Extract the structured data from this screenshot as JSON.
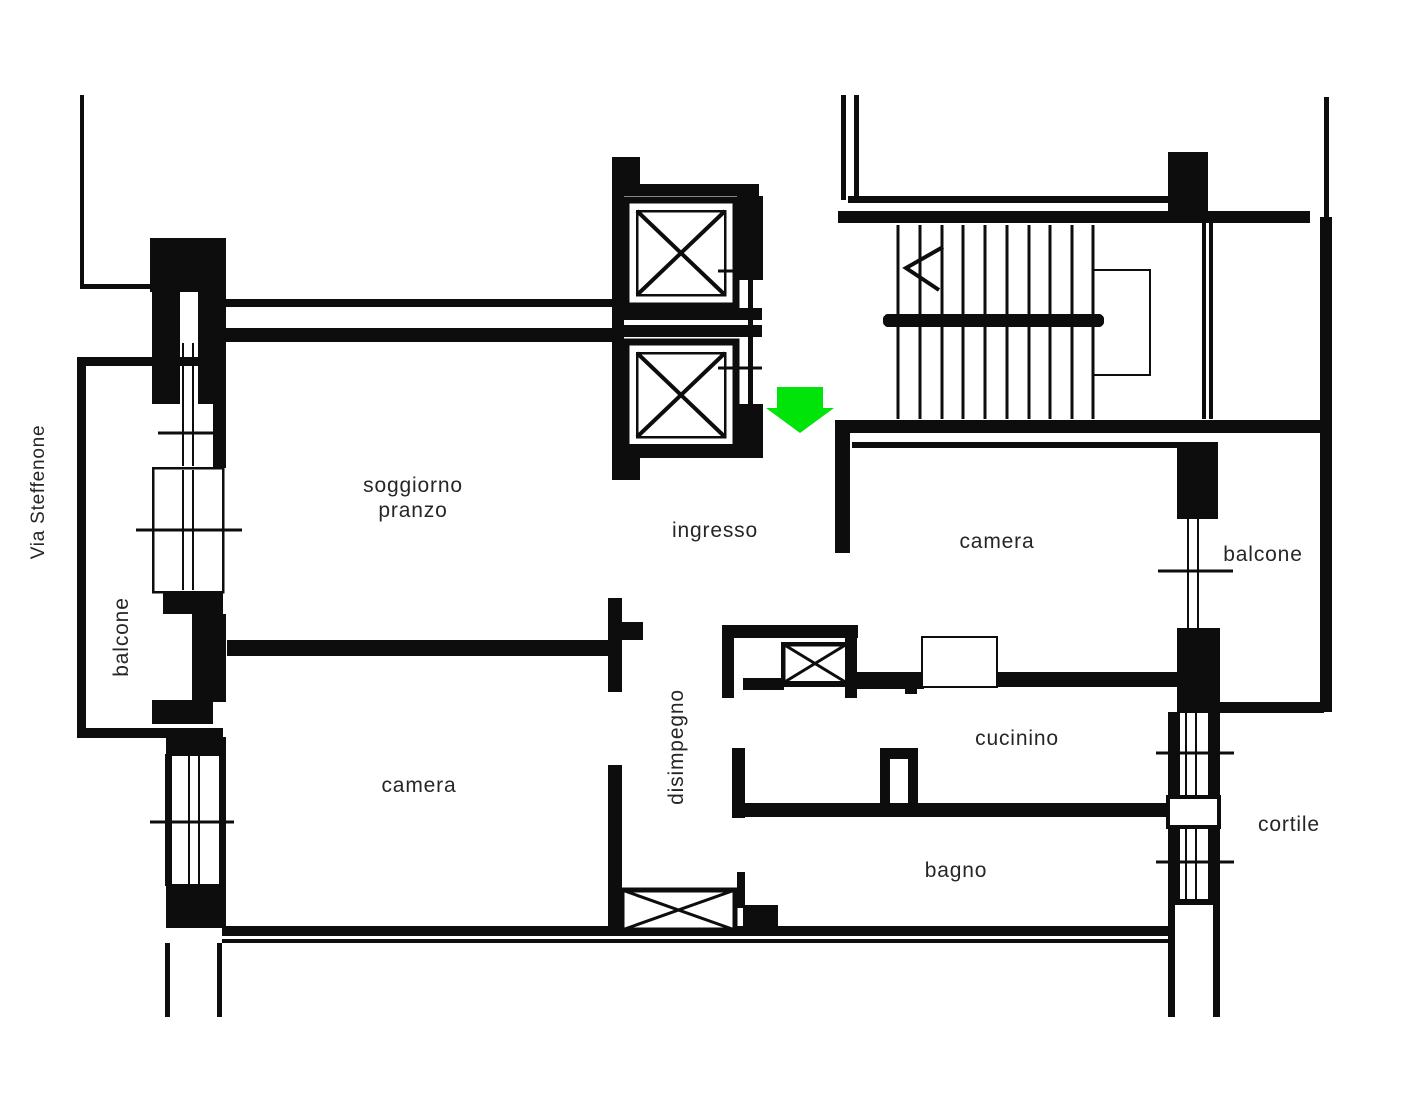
{
  "plan": {
    "street": "Via Steffenone",
    "labels": {
      "balcone_left": "balcone",
      "soggiorno_line1": "soggiorno",
      "soggiorno_line2": "pranzo",
      "ingresso": "ingresso",
      "camera_top": "camera",
      "balcone_right": "balcone",
      "disimpegno": "disimpegno",
      "camera_bottom": "camera",
      "cucinino": "cucinino",
      "bagno": "bagno",
      "cortile": "cortile"
    },
    "entrance_arrow": {
      "direction": "down",
      "color": "#00e40a"
    },
    "colors": {
      "wall": "#0d0d0d",
      "text": "#262626",
      "background": "#ffffff"
    }
  }
}
